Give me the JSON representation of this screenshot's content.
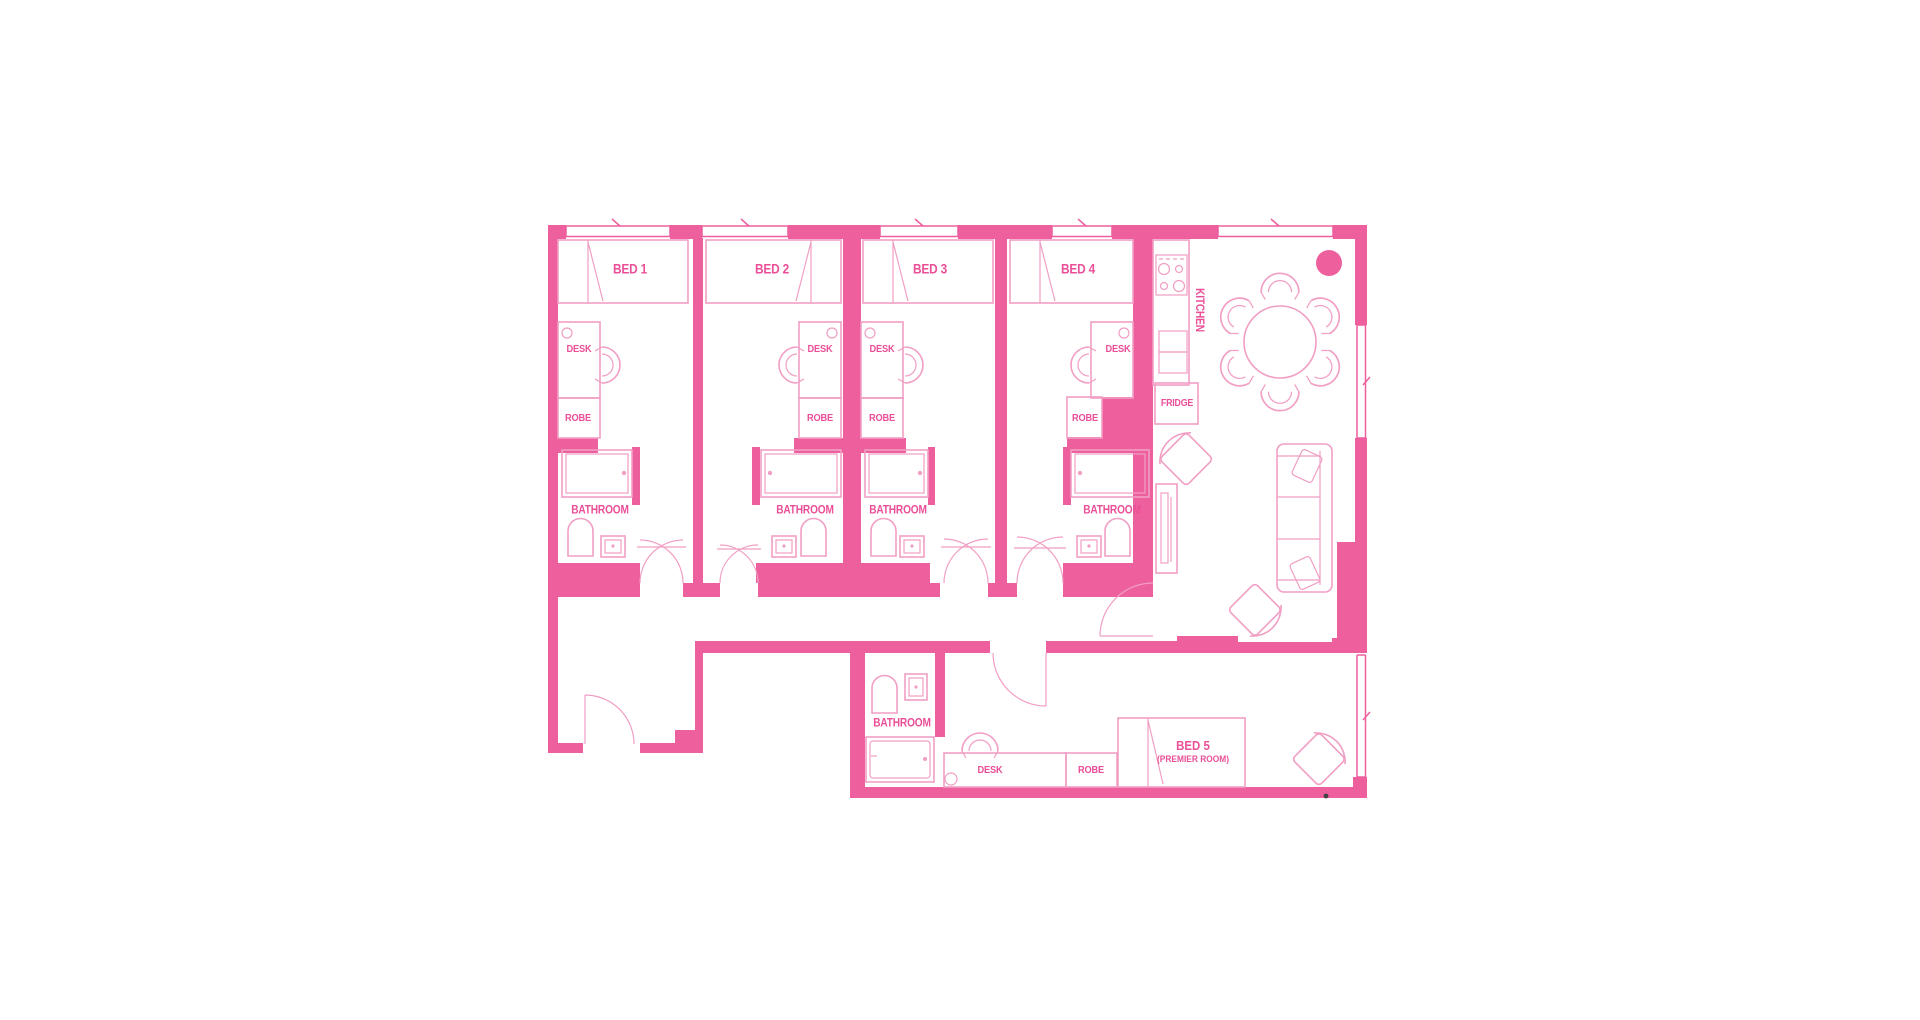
{
  "labels": {
    "bed1": "BED 1",
    "bed2": "BED 2",
    "bed3": "BED 3",
    "bed4": "BED 4",
    "bed5": "BED 5",
    "bed5_sub": "(PREMIER ROOM)",
    "desk": "DESK",
    "robe": "ROBE",
    "bathroom": "BATHROOM",
    "kitchen": "KITCHEN",
    "fridge": "FRIDGE"
  },
  "colors": {
    "wall": "#ee5f9d",
    "line": "#f19ec4",
    "text": "#ea4f97",
    "bg": "#ffffff"
  }
}
